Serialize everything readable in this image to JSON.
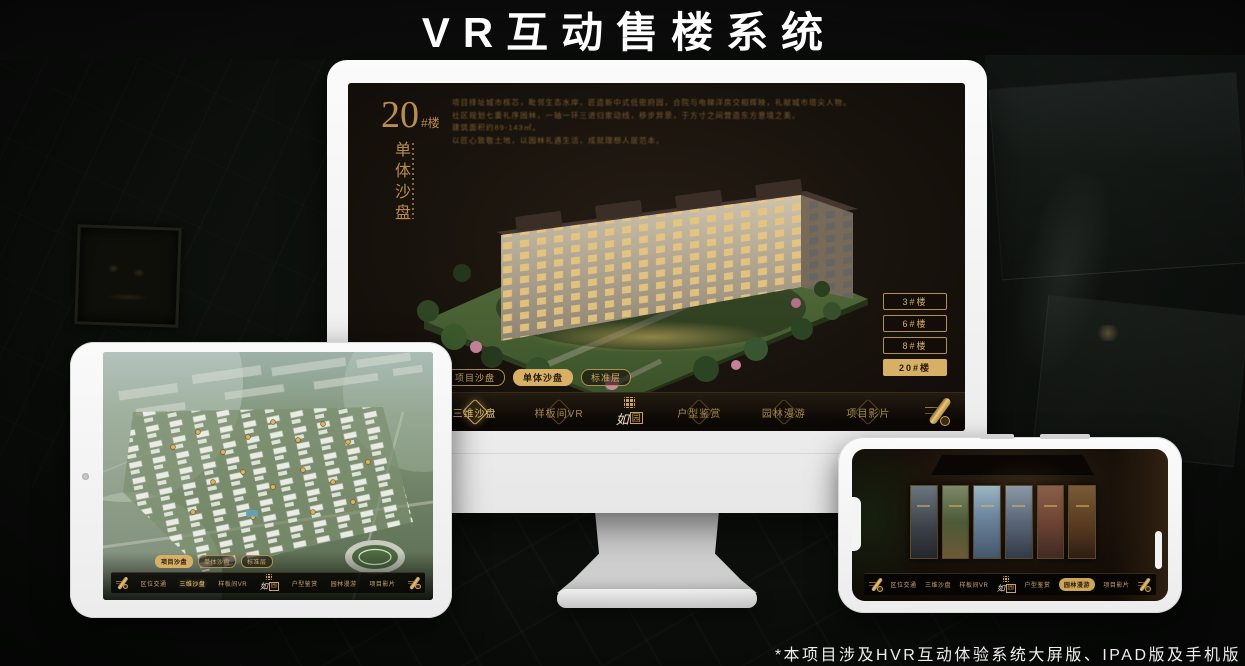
{
  "page": {
    "title": "VR互动售楼系统",
    "footnote": "*本项目涉及HVR互动体验系统大屏版、IPAD版及手机版"
  },
  "brand": {
    "logo_char1": "如",
    "logo_char2": "园"
  },
  "colors": {
    "gold": "#c9a25c",
    "gold_bright": "#d8b065",
    "screen_bg": "#19130d",
    "device_white": "#f4f4f4"
  },
  "sandbox_app": {
    "title_number": "20",
    "title_unit": "#楼",
    "title_vertical": "单体沙盘",
    "description_lines": [
      "项目择址城市核芯，毗邻生态水岸，匠造新中式低密府园，合院与电梯洋房交相辉映，礼献城市塔尖人物。",
      "社区规划七重礼序园林，一轴一环三进归家动线，移步异景，于方寸之间营造东方意境之美。",
      "建筑面积约89-143㎡。",
      "以匠心致敬土地，以园林礼遇生活，成就理想人居范本。"
    ],
    "tower_buttons": [
      {
        "label": "3#楼"
      },
      {
        "label": "6#楼"
      },
      {
        "label": "8#楼"
      },
      {
        "label": "20#楼"
      }
    ],
    "subtabs": [
      {
        "label": "项目沙盘"
      },
      {
        "label": "单体沙盘"
      },
      {
        "label": "标准层"
      }
    ],
    "nav_items": [
      {
        "label": "区位交通"
      },
      {
        "label": "三维沙盘"
      },
      {
        "label": "样板间VR"
      },
      {
        "label": "户型鉴赏"
      },
      {
        "label": "园林漫游"
      },
      {
        "label": "项目影片"
      }
    ]
  }
}
